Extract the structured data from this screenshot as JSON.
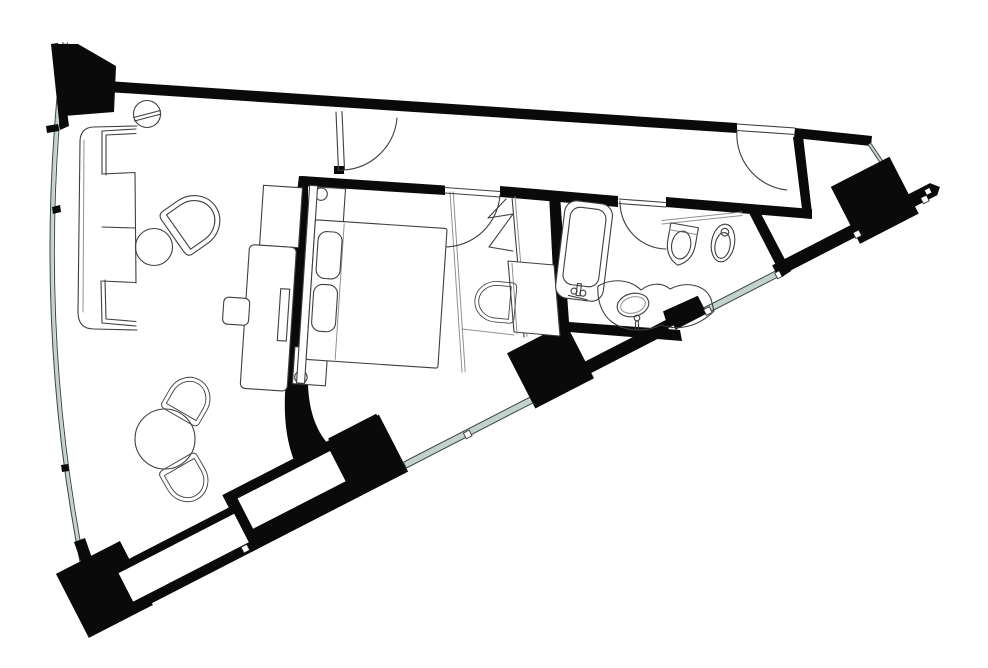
{
  "document": {
    "title": "Suite floor plan",
    "type": "architectural floor plan",
    "visible_text": "none"
  },
  "colors": {
    "background": "#ffffff",
    "wall": "#0a0a0a",
    "line": "#3f3f3f",
    "line_light": "#909090",
    "glass": "#c4d2cc",
    "glass_edge": "#39463f"
  },
  "rooms": [
    {
      "id": "living-room",
      "label": "Living room",
      "fixtures": [
        "corner-sofa",
        "floor-lamp",
        "armchair",
        "side-table",
        "dining-table",
        "dining-chair-north",
        "dining-chair-south",
        "credenza",
        "tv-panel",
        "stool"
      ]
    },
    {
      "id": "bedroom",
      "label": "Bedroom",
      "fixtures": [
        "double-bed",
        "headboard",
        "pillow-left",
        "pillow-right",
        "nightstand-north",
        "nightstand-south",
        "table-lamp-north",
        "table-lamp-south"
      ]
    },
    {
      "id": "dressing-corridor",
      "label": "Dressing corridor",
      "fixtures": [
        "wardrobe-hanging-symbol",
        "desk",
        "desk-chair"
      ]
    },
    {
      "id": "bathroom",
      "label": "Bathroom",
      "fixtures": [
        "bathtub",
        "bath-mixer",
        "vanity-counter",
        "washbasin",
        "basin-tap"
      ]
    },
    {
      "id": "wc-niche",
      "label": "WC niche",
      "fixtures": [
        "toilet",
        "bidet",
        "shelf-ledge"
      ]
    },
    {
      "id": "entry-corridor",
      "label": "Entry corridor",
      "fixtures": []
    },
    {
      "id": "entry-hall",
      "label": "Entry hall",
      "fixtures": []
    }
  ],
  "doors": [
    "entry-door",
    "living-room-door",
    "bedroom-door",
    "bathroom-door"
  ],
  "structure": {
    "columns": [
      "column-top-left",
      "column-facade-mid",
      "column-facade-right"
    ],
    "glazing": [
      "curved-west-facade",
      "south-east-facade-glass-a",
      "south-east-facade-glass-b",
      "entry-sidelight"
    ],
    "facade_wall_niches": 2
  }
}
